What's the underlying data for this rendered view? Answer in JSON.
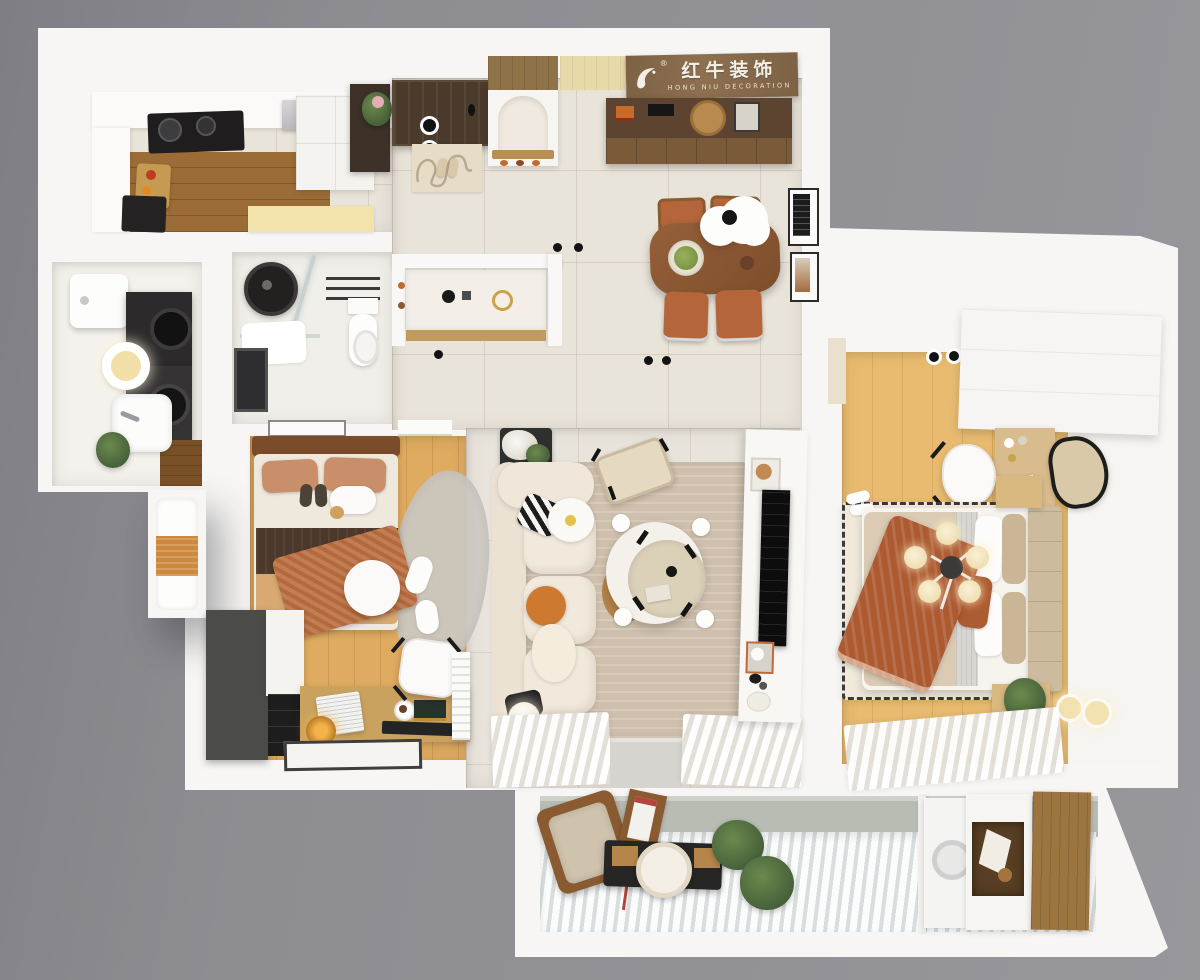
{
  "brand": {
    "cn": "红牛装饰",
    "en": "HONG NIU DECORATION",
    "reg": "®"
  },
  "scene": {
    "type": "3d-floorplan-top-down-render",
    "rooms": [
      "kitchen",
      "entry",
      "dining",
      "hallway",
      "bathroom",
      "wash-area",
      "laundry",
      "bedroom-2",
      "study",
      "living-room",
      "master-bedroom",
      "balcony"
    ]
  },
  "palette": {
    "background_gray": "#8f8f94",
    "slab_white": "#f7f6f4",
    "tile_floor": "#e9e4da",
    "wood_light": "#e0ac60",
    "wood_master": "#e8bb70",
    "wood_kitchen": "#9c6c36",
    "walnut_table": "#8a5732",
    "terracotta": "#ad5a31",
    "sofa_cream": "#f0e8db",
    "rug_living": "#cfc0ad",
    "balcony_wall": "#b9bcb3",
    "appliance_black": "#2c2a2b",
    "logo_board": "#85694a"
  }
}
